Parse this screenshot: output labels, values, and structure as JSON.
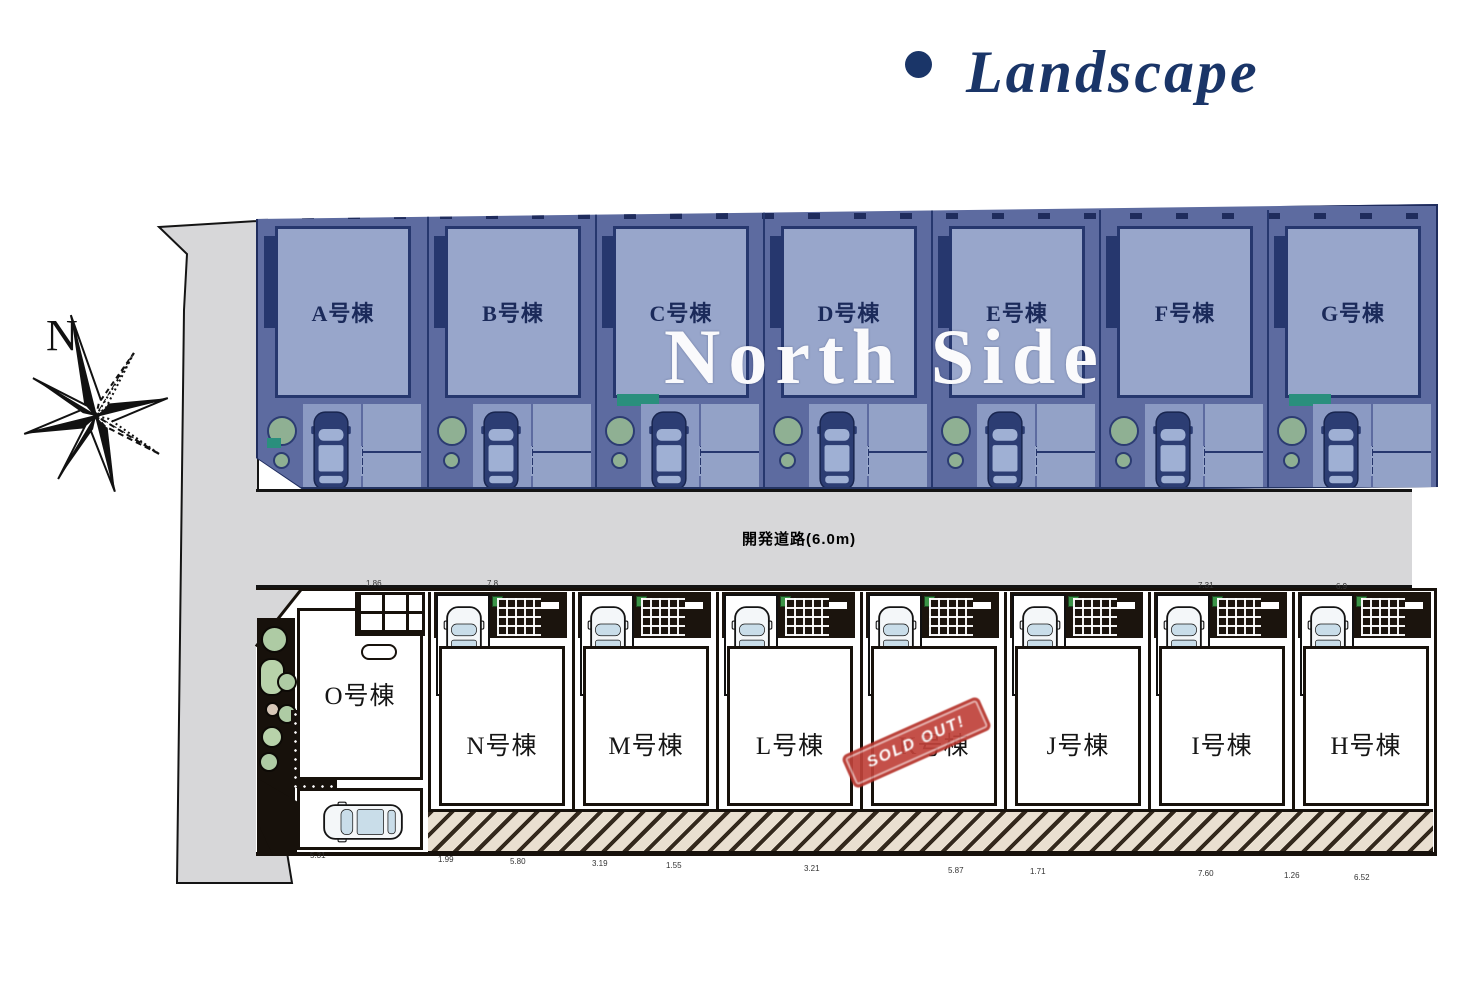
{
  "title": {
    "bullet": "●",
    "text": "Landscape"
  },
  "compass": {
    "north_label": "N"
  },
  "north_section": {
    "overlay_label": "North Side",
    "buildings": [
      {
        "label": "A号棟"
      },
      {
        "label": "B号棟"
      },
      {
        "label": "C号棟"
      },
      {
        "label": "D号棟"
      },
      {
        "label": "E号棟"
      },
      {
        "label": "F号棟"
      },
      {
        "label": "G号棟"
      }
    ]
  },
  "road": {
    "label": "開発道路(6.0m)"
  },
  "south_section": {
    "buildings": [
      {
        "label": "O号棟"
      },
      {
        "label": "N号棟"
      },
      {
        "label": "M号棟"
      },
      {
        "label": "L号棟"
      },
      {
        "label": "K号棟",
        "sold_out": true
      },
      {
        "label": "J号棟"
      },
      {
        "label": "I号棟"
      },
      {
        "label": "H号棟"
      }
    ],
    "sold_out_stamp": "SOLD OUT!"
  },
  "dimensions": {
    "top": [
      "1.86",
      "7.8",
      "7.31",
      "6.9"
    ],
    "bottom": [
      "5.31",
      "1.99",
      "5.80",
      "3.19",
      "1.55",
      "3.21",
      "5.87",
      "1.71",
      "7.60",
      "1.26",
      "6.52"
    ]
  },
  "icons": {
    "compass": "compass-rose",
    "car": "car-top-view",
    "tree": "tree-circle"
  },
  "colors": {
    "title_navy": "#1a3568",
    "navy_line": "#1f2c5d",
    "north_bg": "#5d6ba0",
    "north_building": "#98a6cb",
    "road_gray": "#d7d7d9",
    "line_black": "#17110b",
    "hatch_bg": "#e9dfd0",
    "teal": "#2a8f7d",
    "lawn_green": "#3b9447",
    "tree_green": "#aecba4",
    "stamp_red": "#b5322a",
    "overlay_white": "#fafafc"
  }
}
